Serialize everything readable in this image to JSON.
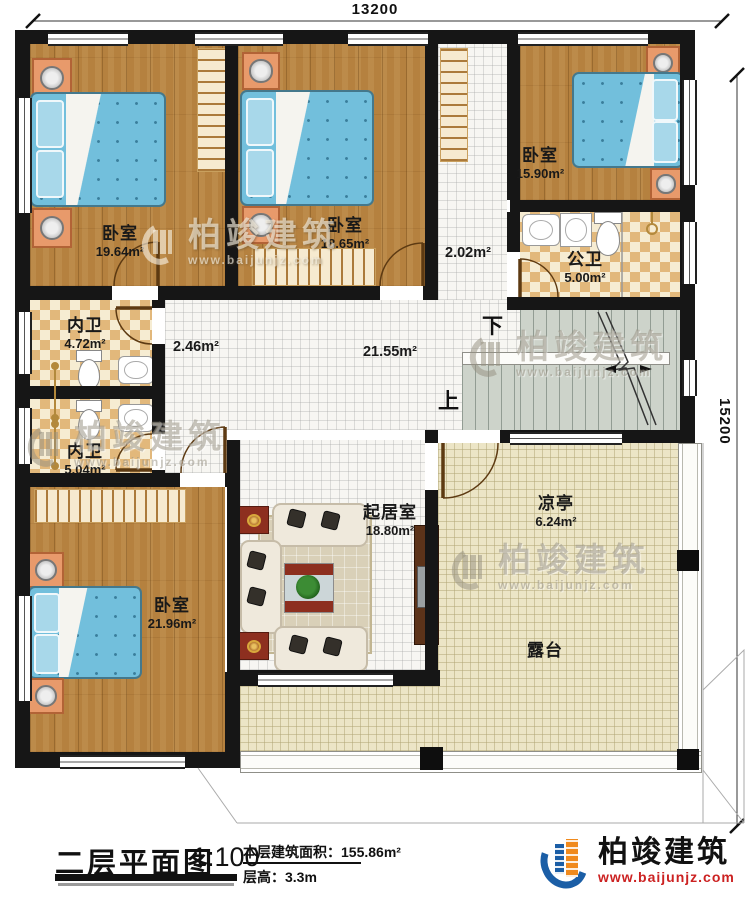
{
  "dimensions": {
    "top": "13200",
    "right": "15200"
  },
  "rooms": {
    "bedroom_tl": {
      "name": "卧室",
      "area": "19.64m²"
    },
    "bedroom_tm": {
      "name": "卧室",
      "area": "18.65m²"
    },
    "bedroom_tr": {
      "name": "卧室",
      "area": "15.90m²"
    },
    "public_bath": {
      "name": "公卫",
      "area": "5.00m²"
    },
    "inner_bath_top": {
      "name": "内卫",
      "area": "4.72m²"
    },
    "inner_bath_bottom": {
      "name": "内卫",
      "area": "5.04m²"
    },
    "bedroom_bl": {
      "name": "卧室",
      "area": "21.96m²"
    },
    "living": {
      "name": "起居室",
      "area": "18.80m²"
    },
    "pavilion": {
      "name": "凉亭",
      "area": "6.24m²"
    },
    "terrace": {
      "name": "露台"
    }
  },
  "open_areas": {
    "hall": "21.55m²",
    "corridor_left": "2.46m²",
    "corridor_right": "2.02m²"
  },
  "stairs": {
    "up": "上",
    "down": "下"
  },
  "title_block": {
    "title": "二层平面图",
    "scale": "1:100",
    "area_label": "本层建筑面积：",
    "area_value": "155.86m²",
    "height_label": "层高：",
    "height_value": "3.3m"
  },
  "brand": {
    "name": "柏竣建筑",
    "website": "www.baijunjz.com"
  },
  "watermark": {
    "name": "柏竣建筑",
    "website": "www.baijunjz.com"
  },
  "colors": {
    "wall": "#161616",
    "wood": "#b5813f",
    "tile-check-a": "#e2b87b",
    "tile-check-b": "#f6ecd2",
    "tile-white": "#f7f6f2",
    "terrace": "#ece5c6",
    "stairs": "#cdd3ca",
    "bed": "#72bfdc",
    "nightstand": "#e89a6b",
    "rug": "#d9d0b8",
    "cabinet": "#5c3319",
    "accent-red": "#8d2f1f",
    "logo-blue": "#1b5ea6",
    "logo-orange": "#f08a1d",
    "logo-red": "#cc2222"
  }
}
